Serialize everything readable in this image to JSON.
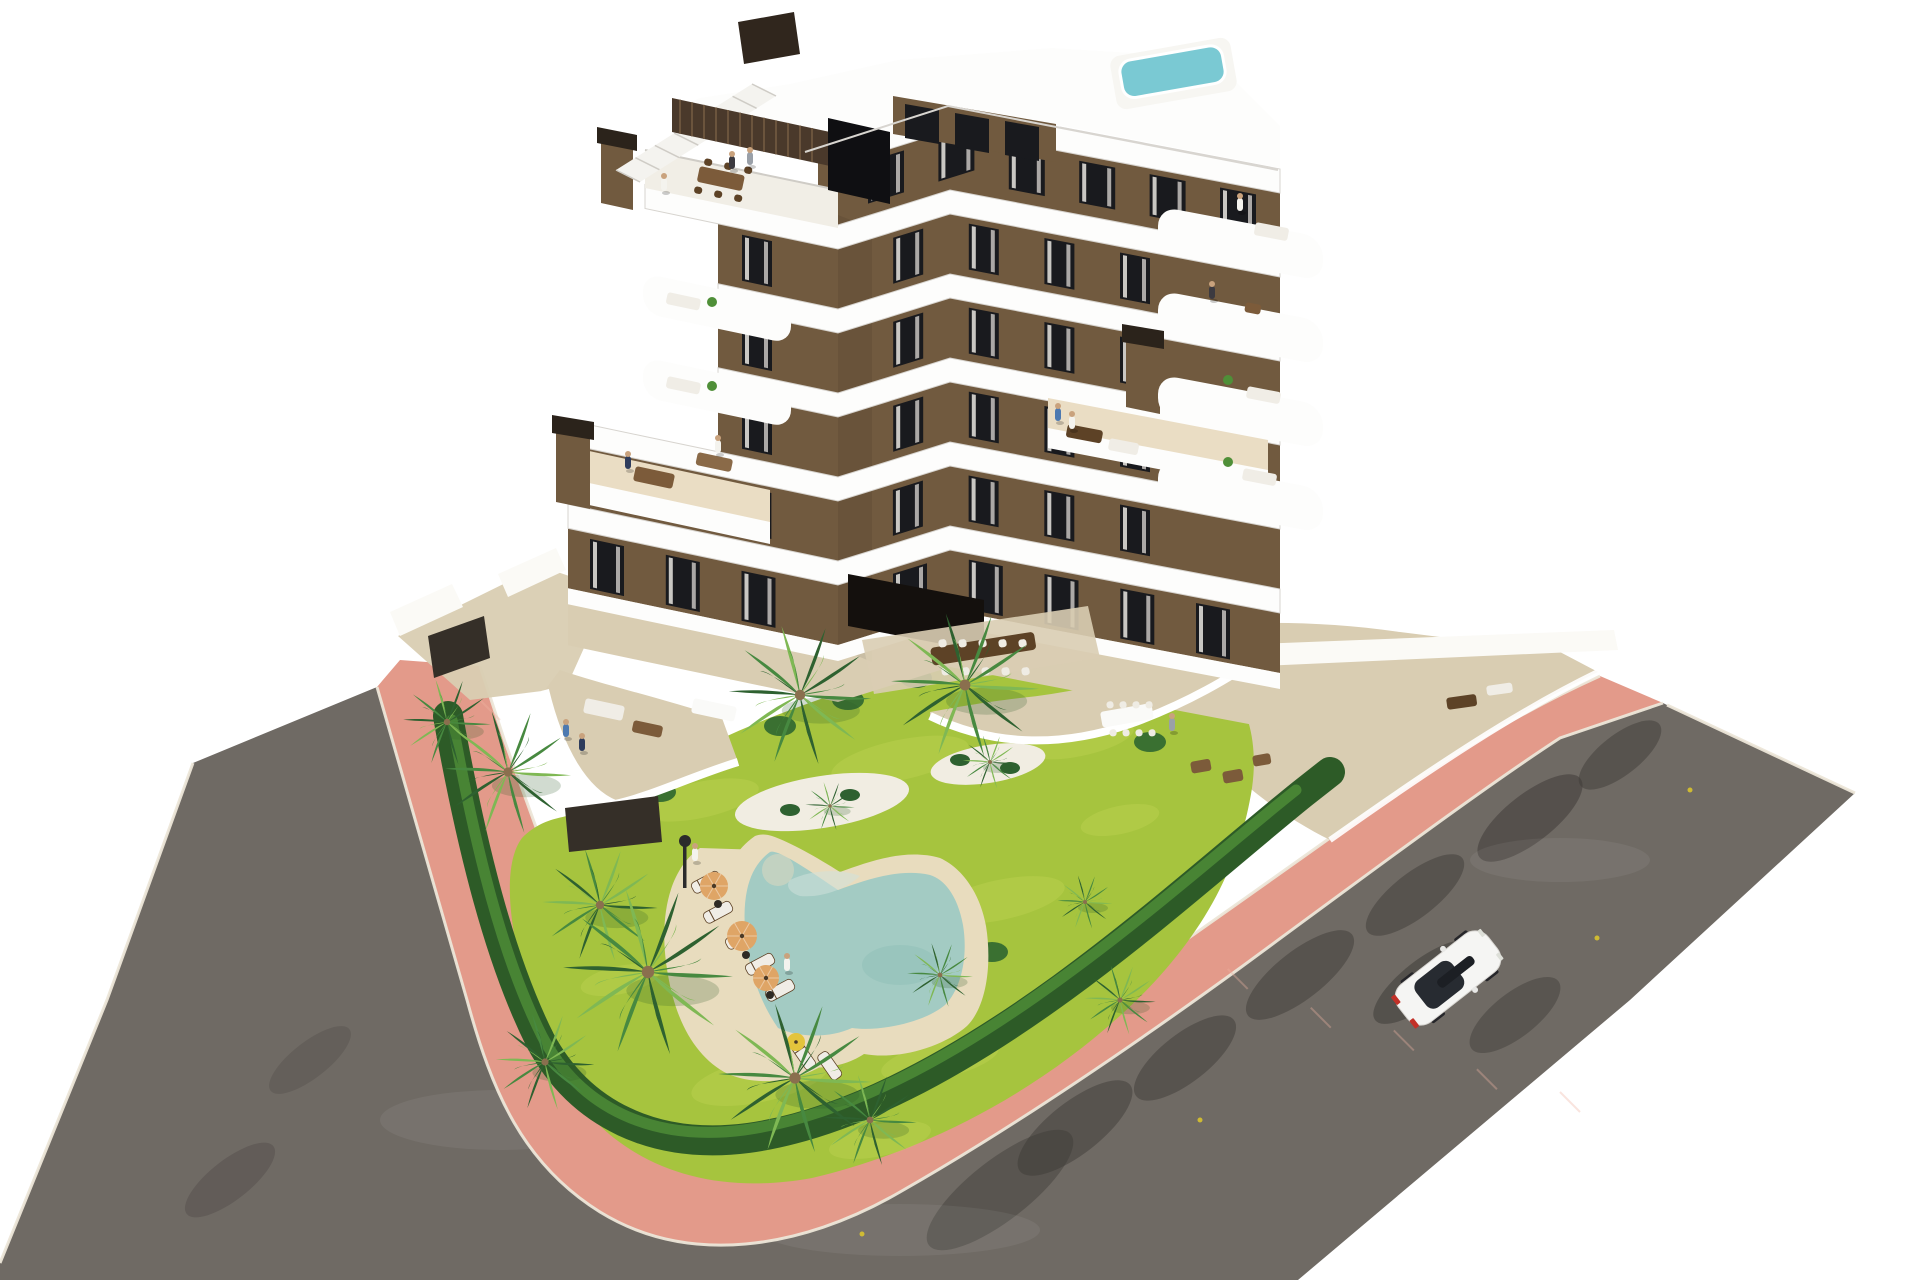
{
  "scene": {
    "title": "Aerial 3D architectural rendering of a modern apartment residence",
    "style": "photorealistic CGI on plain white background",
    "view": "high-angle corner aerial view",
    "setting": "L-shaped asphalt street corner with salmon paved sidewalk wrapping a landscaped private plot"
  },
  "palette": {
    "bg": "#ffffff",
    "road": "#6f6a64",
    "road_light": "#7d7872",
    "road_shadow": "#3f3b38",
    "curb": "#ece6d8",
    "sidewalk": "#e39a8a",
    "sidewalk_light": "#efb4a3",
    "lawn": "#a6c43e",
    "lawn_light": "#c6d65a",
    "hedge": "#2d5b27",
    "hedge_light": "#4f8f38",
    "palm_dark": "#2e6130",
    "palm_mid": "#478940",
    "palm_light": "#7fb854",
    "trunk": "#8a6f4e",
    "gravel": "#f1ede2",
    "sand": "#e8dcbe",
    "pool_water": "#a3cbc3",
    "pool_light": "#cfe2da",
    "pool_deep": "#88b9b1",
    "rooftop_pool": "#7ac9d3",
    "facade": "#715a3f",
    "facade_dark": "#54402f",
    "opening": "#14100d",
    "band": "#fdfdfc",
    "band_shadow": "#d7d4cf",
    "window": "#191a1e",
    "curtain": "#e9e6e0",
    "terrace_floor": "#ead fc4",
    "terrace_floor_fix": "#eaddc4",
    "terrace_stone": "#d9cdb2",
    "wood": "#7c5b3a",
    "wood_dark": "#5d4226",
    "sofa": "#f0EDE6",
    "white_wall": "#fbfaf6",
    "fence": "#352f28",
    "umbrella": "#dfa566",
    "umbrella_yellow": "#e3c43c",
    "car_body": "#f5f5f3",
    "car_glass": "#272b31",
    "car_red": "#c23128",
    "lamp": "#2b2b2b",
    "skin": "#c9a27d"
  },
  "building": {
    "floors_visible": 7,
    "wings": 2,
    "facade_material": "mocha-brown render with white wrap-around balcony bands",
    "band_count": 6,
    "window_rows": [
      {
        "vy": 141,
        "xL": 868,
        "xR": 1256,
        "n": 6,
        "w": 36,
        "h": 42
      },
      {
        "vy": 225,
        "xL": 742,
        "xR": 1150,
        "n": 6,
        "w": 30,
        "h": 46
      },
      {
        "vy": 309,
        "xL": 742,
        "xR": 1150,
        "n": 6,
        "w": 30,
        "h": 46
      },
      {
        "vy": 393,
        "xL": 742,
        "xR": 1150,
        "n": 6,
        "w": 30,
        "h": 46
      },
      {
        "vy": 477,
        "xL": 590,
        "xR": 1150,
        "n": 8,
        "w": 30,
        "h": 46
      },
      {
        "vy": 561,
        "xL": 590,
        "xR": 1230,
        "n": 9,
        "w": 34,
        "h": 50
      }
    ],
    "features": [
      "rooftop plunge pool",
      "roof access staircase",
      "timber-slat roof feature wall",
      "three brown chimney stacks",
      "stacked rounded white balconies",
      "two large setback roof terraces",
      "communal courtyard dining terrace"
    ]
  },
  "garden": {
    "palm_count": 14,
    "gravel_islands": 2,
    "lawn_finish": "bright yellow-green grass",
    "perimeter": "clipped dark green hedge inside pink sidewalk",
    "lamp_posts": 1
  },
  "pool": {
    "shape": "freeform boomerang lagoon with sand beach deck",
    "loungers": 7,
    "parasols_orange": 3,
    "parasols_yellow": 1
  },
  "street": {
    "layout": "L-shaped corner road",
    "surface": "dark asphalt with tree shadows",
    "sidewalk": "salmon pink pavers with pale curbs",
    "cars": [
      {
        "color": "white",
        "type": "hatchback",
        "heading": "north-east",
        "detail": "red tail lights, black glass roof"
      }
    ]
  },
  "people": {
    "count": 14,
    "colors": {
      "navy": "#2e3c5c",
      "white": "#f4f3ee",
      "blue": "#4d79b0",
      "gray": "#9aa0a8",
      "dark": "#3c3a40"
    },
    "locations": [
      "roof terrace dining",
      "upper balconies",
      "setback terraces",
      "ground patios",
      "garden path",
      "sun loungers"
    ]
  }
}
